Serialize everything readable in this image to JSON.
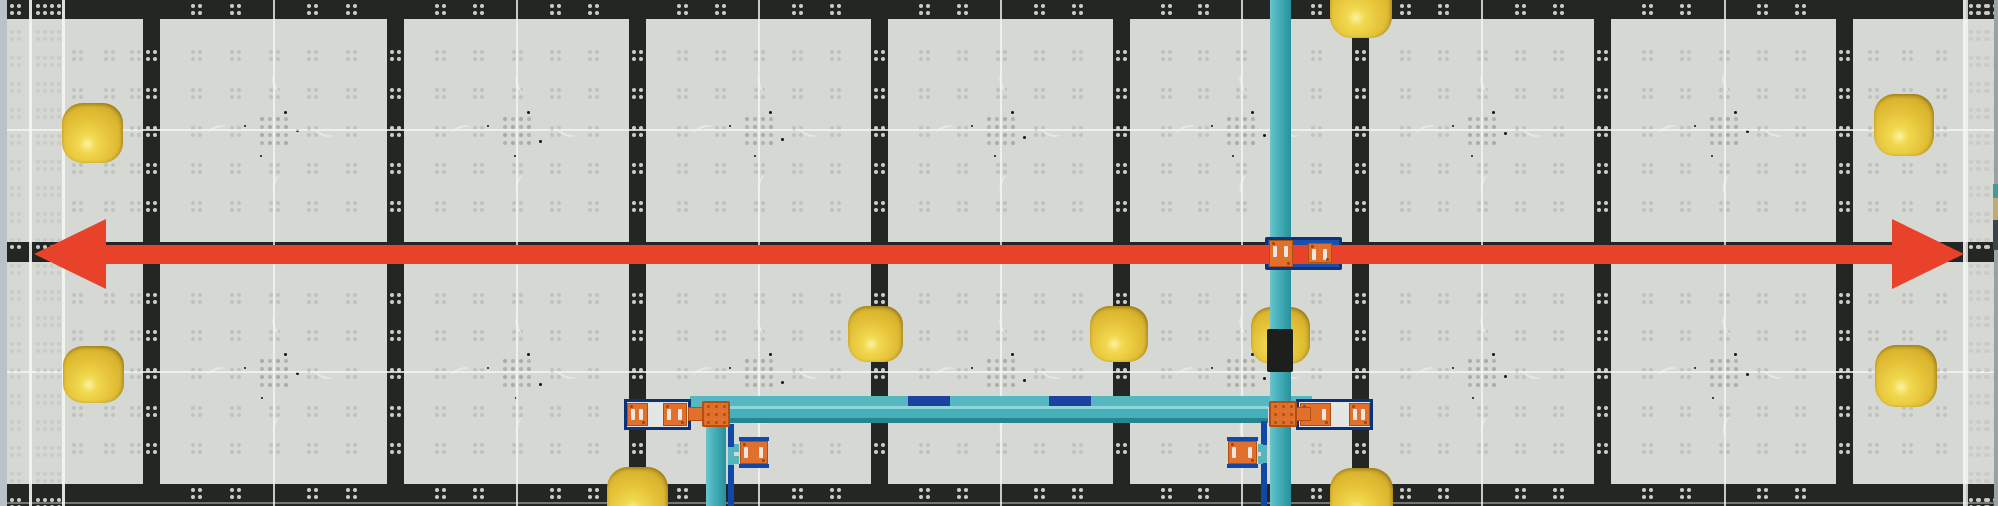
{
  "scene": {
    "width": 1998,
    "height": 506,
    "colors": {
      "tileBase": "#d6d8d4",
      "tileDot": "#c0c2be",
      "centerDot": "#b2b4b0",
      "seam": "#242624",
      "seamDot": "#c9ccc8",
      "whiteLine": "#f4f6f2",
      "squiggle": "#e9ebe7",
      "speck": "#161614",
      "arrowRed": "#e8432a",
      "pipeTeal": "#45b1bb",
      "rail": "#55b8c0",
      "navy": "#1e41a0",
      "frameBlue": "#1147a6",
      "frameDark": "#0d3176",
      "frameInner": "#e3e6e3",
      "orange": "#e0702b",
      "orangeDark": "#b24f10",
      "slotWhite": "#ece7e0",
      "ballBody": "#e5c238",
      "ballDark": "#c19d28",
      "leftStrip": "#b7c2c9",
      "rightStrip": "#9aa0a3"
    }
  },
  "field": {
    "v_seams": [
      143,
      387,
      629,
      871,
      1113,
      1352,
      1594,
      1836
    ],
    "seam_width": 17,
    "h_seams": [
      {
        "y": 0,
        "h": 19
      },
      {
        "y": 242,
        "h": 20
      },
      {
        "y": 484,
        "h": 22
      }
    ],
    "tile_cols": [
      [
        160,
        387
      ],
      [
        404,
        629
      ],
      [
        646,
        871
      ],
      [
        888,
        1113
      ],
      [
        1130,
        1352
      ],
      [
        1369,
        1594
      ],
      [
        1611,
        1836
      ]
    ],
    "tile_rows": [
      [
        19,
        242
      ],
      [
        262,
        484
      ]
    ],
    "center_line_xs": [
      273,
      516,
      758,
      1000,
      1241,
      1481,
      1724,
      1966
    ],
    "center_line_ys": [
      129,
      371
    ],
    "cluster_fractions": [
      0.16,
      0.33,
      0.5,
      0.67,
      0.84
    ],
    "left_edge": {
      "strip": {
        "x": 0,
        "w": 7
      },
      "white_lines_x": [
        29,
        62
      ],
      "dot_cols_full": [
        10,
        36,
        50
      ],
      "dot_cols_rows": [
        72,
        104,
        130
      ]
    },
    "right_edge": {
      "white_line_x": 1963,
      "dot_cols_full": [
        1969,
        1977,
        1986
      ],
      "dot_cols_rows": [
        1868,
        1902,
        1936
      ],
      "far_strip": {
        "x": 1994,
        "w": 4
      },
      "stack": [
        {
          "y": 184,
          "h": 14,
          "color": "#3b9e98"
        },
        {
          "y": 198,
          "h": 22,
          "color": "#c3a96b"
        },
        {
          "y": 220,
          "h": 30,
          "color": "#3d4449"
        }
      ]
    },
    "bottom_light_line_y": 502
  },
  "arrow": {
    "shaft": {
      "x": 90,
      "y": 245,
      "w": 1818,
      "h": 19
    },
    "head_left": {
      "x": 34,
      "y": 219,
      "w": 72,
      "h": 70
    },
    "head_right": {
      "x": 1892,
      "y": 219,
      "w": 72,
      "h": 70
    }
  },
  "balls": [
    {
      "x": 62,
      "y": 103,
      "w": 61,
      "h": 60,
      "layer": "top"
    },
    {
      "x": 63,
      "y": 346,
      "w": 61,
      "h": 57,
      "layer": "top"
    },
    {
      "x": 607,
      "y": 467,
      "w": 61,
      "h": 62,
      "layer": "top"
    },
    {
      "x": 848,
      "y": 306,
      "w": 55,
      "h": 56,
      "layer": "top"
    },
    {
      "x": 1090,
      "y": 306,
      "w": 58,
      "h": 56,
      "layer": "top"
    },
    {
      "x": 1251,
      "y": 307,
      "w": 59,
      "h": 57,
      "layer": "under-pipe"
    },
    {
      "x": 1330,
      "y": -26,
      "w": 62,
      "h": 64,
      "layer": "top"
    },
    {
      "x": 1330,
      "y": 468,
      "w": 63,
      "h": 62,
      "layer": "top"
    },
    {
      "x": 1874,
      "y": 94,
      "w": 60,
      "h": 62,
      "layer": "top"
    },
    {
      "x": 1875,
      "y": 345,
      "w": 62,
      "h": 62,
      "layer": "top"
    }
  ],
  "pipes": {
    "main_vertical": {
      "x": 1270,
      "y": 0,
      "w": 21,
      "h": 506
    },
    "left_drop": {
      "x": 706,
      "y": 414,
      "w": 20,
      "h": 92
    },
    "thick_horizontal": {
      "x": 729,
      "y": 406,
      "w": 539,
      "h": 17
    },
    "rail": {
      "x": 690,
      "y": 396,
      "w": 622,
      "h": 11
    },
    "rail_segments": [
      {
        "x": 908,
        "y": 396,
        "w": 42,
        "h": 11
      },
      {
        "x": 1049,
        "y": 396,
        "w": 42,
        "h": 11
      }
    ],
    "rods": [
      {
        "x": 728,
        "y": 424,
        "w": 6,
        "h": 82
      },
      {
        "x": 1261,
        "y": 421,
        "w": 6,
        "h": 85
      }
    ],
    "rod_dashes": [
      {
        "x": 728,
        "y": 447,
        "w": 6,
        "h": 18
      },
      {
        "x": 1261,
        "y": 445,
        "w": 6,
        "h": 18
      }
    ]
  },
  "connectors": {
    "junctions": [
      {
        "x": 702,
        "y": 401,
        "w": 28,
        "h": 26
      },
      {
        "x": 1269,
        "y": 401,
        "w": 28,
        "h": 26
      }
    ],
    "nubs": [
      {
        "x": 688,
        "y": 407,
        "w": 15,
        "h": 14
      },
      {
        "x": 1296,
        "y": 407,
        "w": 15,
        "h": 14
      }
    ],
    "frames": [
      {
        "x": 624,
        "y": 399,
        "w": 67,
        "h": 31
      },
      {
        "x": 1296,
        "y": 399,
        "w": 77,
        "h": 31
      }
    ],
    "frame_plates": [
      {
        "x": 627,
        "y": 403,
        "w": 21,
        "h": 23
      },
      {
        "x": 663,
        "y": 403,
        "w": 24,
        "h": 23
      },
      {
        "x": 1300,
        "y": 403,
        "w": 31,
        "h": 23
      },
      {
        "x": 1349,
        "y": 403,
        "w": 21,
        "h": 23
      }
    ],
    "stand_plates": [
      {
        "x": 739,
        "y": 437,
        "w": 30,
        "h": 31,
        "side": "left"
      },
      {
        "x": 1227,
        "y": 437,
        "w": 31,
        "h": 31,
        "side": "right"
      }
    ],
    "bracket": {
      "x": 1265,
      "y": 237,
      "w": 77,
      "h": 33
    },
    "bracket_plates": [
      {
        "x": 1269,
        "y": 240,
        "w": 24,
        "h": 27
      },
      {
        "x": 1308,
        "y": 243,
        "w": 24,
        "h": 20
      }
    ],
    "collar": {
      "x": 1267,
      "y": 329,
      "w": 26,
      "h": 43
    }
  }
}
